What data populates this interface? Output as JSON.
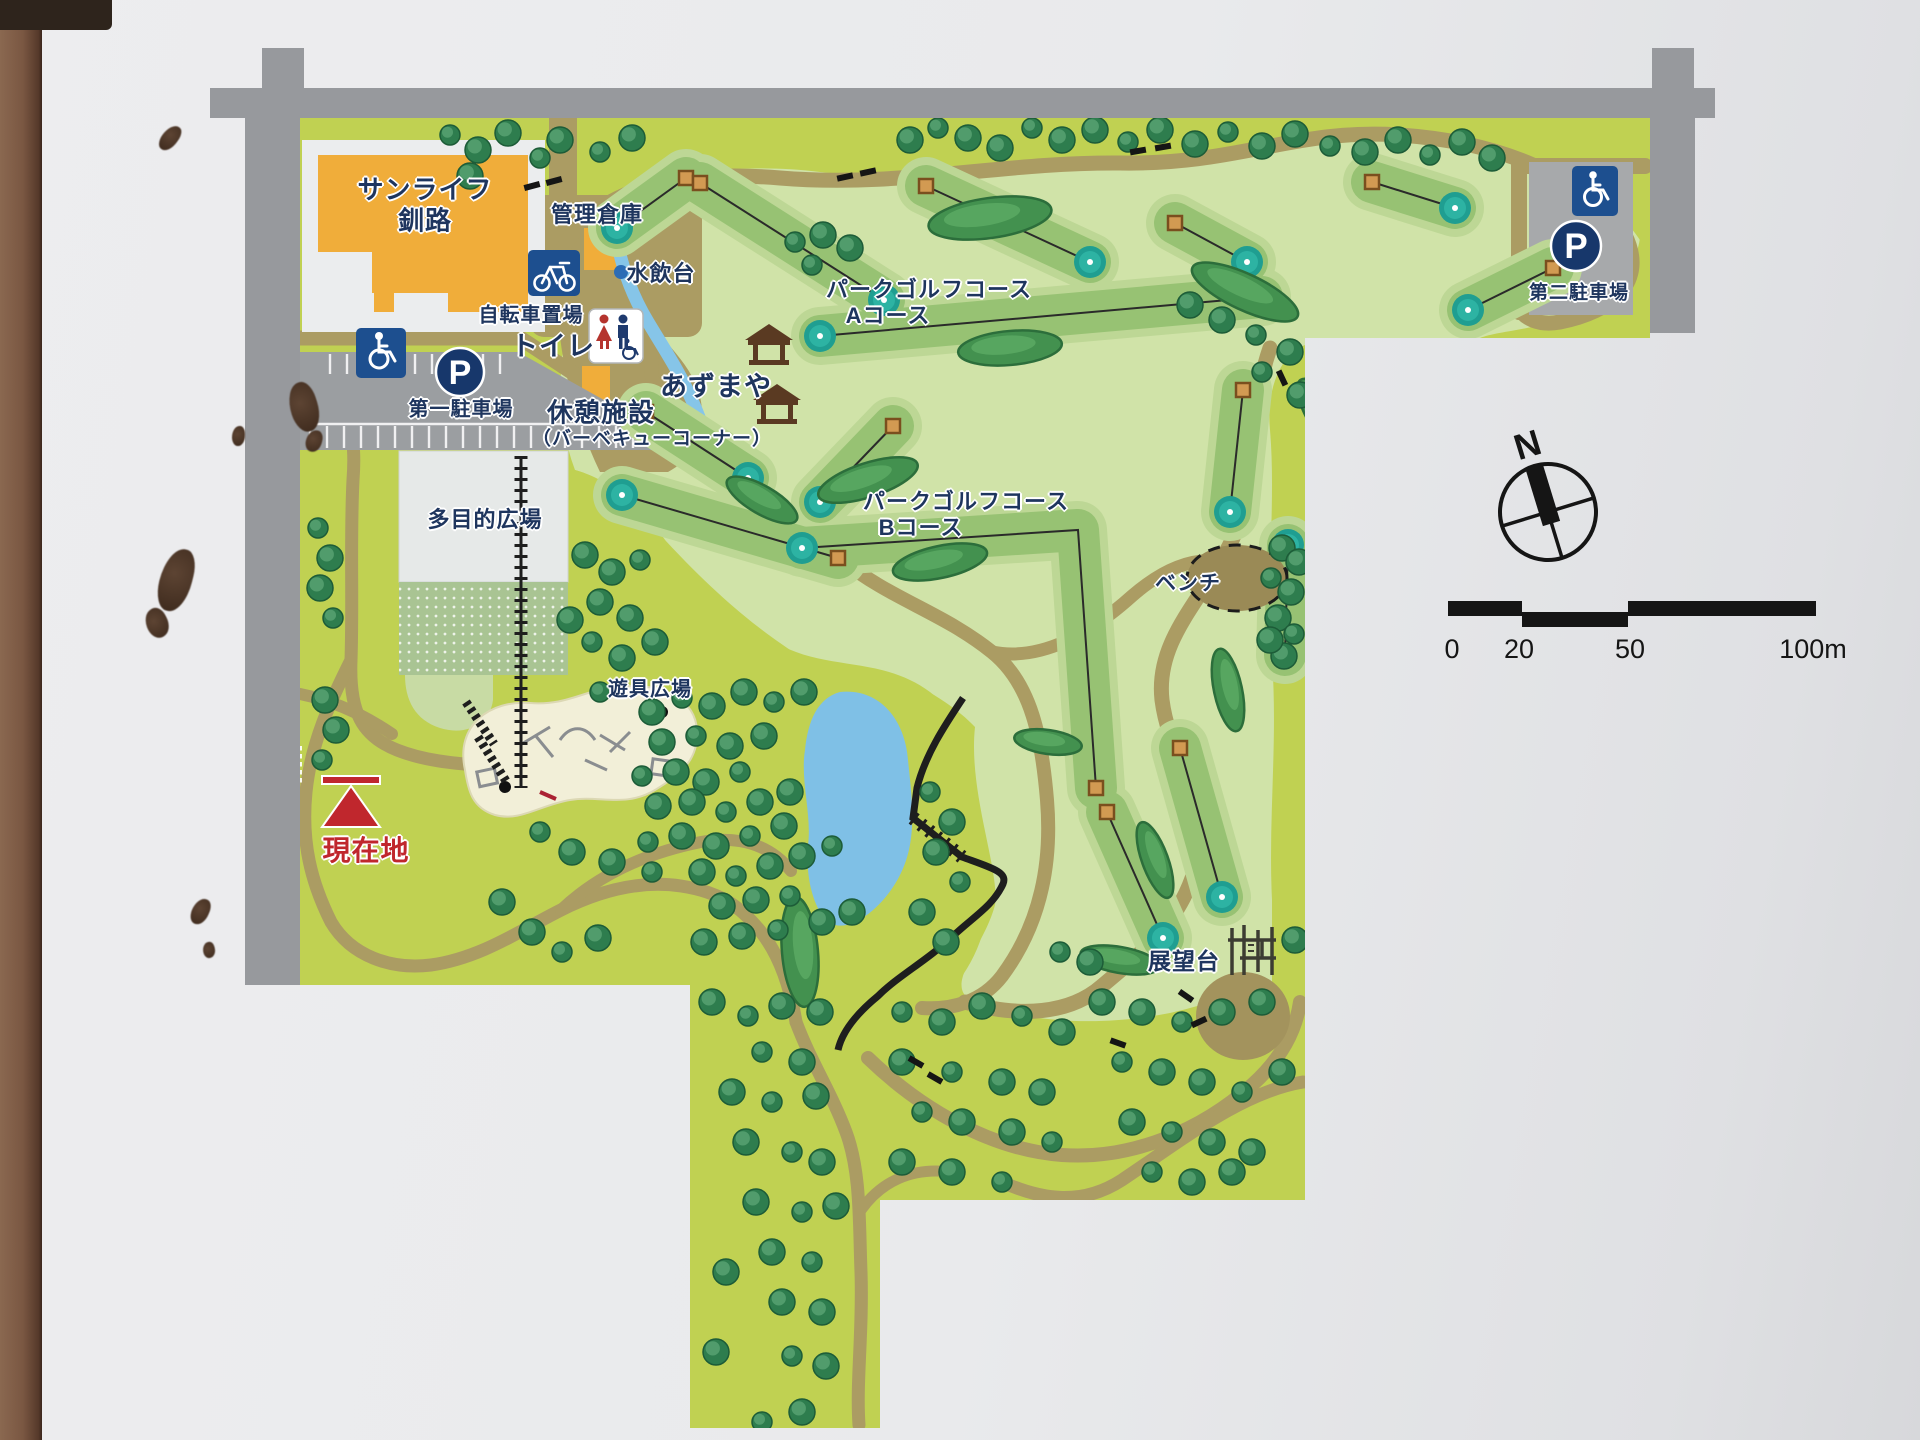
{
  "labels": {
    "sunlife1": "サンライフ",
    "sunlife2": "釧路",
    "kanri": "管理倉庫",
    "mizunomi": "水飲台",
    "jitensha": "自転車置場",
    "toilet": "トイレ",
    "azumaya": "あずまや",
    "kyukei1": "休憩施設",
    "kyukei2": "（バーベキューコーナー）",
    "parking1": "第一駐車場",
    "tamokuteki": "多目的広場",
    "yugu": "遊具広場",
    "genzaichi": "現在地",
    "courseA1": "パークゴルフコース",
    "courseA2": "Aコース",
    "courseB1": "パークゴルフコース",
    "courseB2": "Bコース",
    "bench": "ベンチ",
    "tenbodai": "展望台",
    "parking2": "第二駐車場",
    "compass_n": "N",
    "p_letter": "P"
  },
  "scalebar": {
    "ticks": [
      "0",
      "20",
      "50",
      "100m"
    ]
  },
  "colors": {
    "map_yellow": "#c0d152",
    "golf_green": "#d0e3a8",
    "fairway": "#97c273",
    "fairway_halo": "#bdd795",
    "putting_green": "#1f9e91",
    "road_gray": "#97999d",
    "parking_gray": "#9b9ea1",
    "parking2_gray": "#a7a9ab",
    "path_tan": "#ab9c63",
    "water_blue": "#86c5e8",
    "building_orange": "#f0ad3a",
    "tree_green": "#2e7d4e",
    "label_navy": "#1e355e",
    "location_red": "#c0272d",
    "icon_blue": "#1d4f8f",
    "p_navy": "#17376b",
    "playground_cream": "#f2efd8"
  },
  "map": {
    "holes": [
      {
        "tee": [
          686,
          178
        ],
        "green": [
          617,
          228
        ]
      },
      {
        "tee": [
          700,
          183
        ],
        "green": [
          884,
          300
        ]
      },
      {
        "tee": [
          926,
          186
        ],
        "green": [
          1090,
          262
        ]
      },
      {
        "tee": [
          1175,
          223
        ],
        "green": [
          1247,
          262
        ]
      },
      {
        "tee": [
          1262,
          297
        ],
        "green": [
          820,
          336
        ]
      },
      {
        "tee": [
          1553,
          268
        ],
        "green": [
          1468,
          310
        ]
      },
      {
        "tee": [
          1372,
          182
        ],
        "green": [
          1455,
          208
        ]
      },
      {
        "tee": [
          1243,
          390
        ],
        "green": [
          1230,
          512
        ]
      },
      {
        "tee": [
          646,
          412
        ],
        "green": [
          748,
          478
        ]
      },
      {
        "tee": [
          893,
          426
        ],
        "green": [
          820,
          502
        ]
      },
      {
        "tee": [
          838,
          558
        ],
        "green": [
          622,
          495
        ]
      },
      {
        "tee": [
          1096,
          788
        ],
        "elbow": [
          1078,
          530
        ],
        "green": [
          802,
          548
        ]
      },
      {
        "tee": [
          1285,
          655
        ],
        "green": [
          1288,
          545
        ]
      },
      {
        "tee": [
          1180,
          748
        ],
        "green": [
          1222,
          897
        ]
      },
      {
        "tee": [
          1107,
          812
        ],
        "green": [
          1163,
          938
        ]
      }
    ],
    "bushes": [
      [
        990,
        218,
        62,
        20,
        -8
      ],
      [
        1245,
        292,
        58,
        18,
        25
      ],
      [
        1010,
        348,
        52,
        17,
        -5
      ],
      [
        1332,
        425,
        55,
        18,
        55
      ],
      [
        868,
        480,
        52,
        17,
        -18
      ],
      [
        940,
        562,
        48,
        16,
        -12
      ],
      [
        762,
        500,
        40,
        14,
        30
      ],
      [
        1228,
        690,
        42,
        14,
        78
      ],
      [
        1048,
        742,
        34,
        12,
        8
      ],
      [
        1155,
        860,
        40,
        13,
        70
      ],
      [
        800,
        952,
        55,
        18,
        85
      ],
      [
        1120,
        960,
        40,
        13,
        10
      ]
    ],
    "trees": [
      [
        450,
        135
      ],
      [
        478,
        150
      ],
      [
        508,
        133
      ],
      [
        540,
        158
      ],
      [
        470,
        176
      ],
      [
        560,
        140
      ],
      [
        600,
        152
      ],
      [
        632,
        138
      ],
      [
        910,
        140
      ],
      [
        938,
        128
      ],
      [
        968,
        138
      ],
      [
        1000,
        148
      ],
      [
        1032,
        128
      ],
      [
        1062,
        140
      ],
      [
        1095,
        130
      ],
      [
        1128,
        142
      ],
      [
        1160,
        130
      ],
      [
        1195,
        144
      ],
      [
        1228,
        132
      ],
      [
        1262,
        146
      ],
      [
        1295,
        134
      ],
      [
        1330,
        146
      ],
      [
        1365,
        152
      ],
      [
        1398,
        140
      ],
      [
        1430,
        155
      ],
      [
        1462,
        142
      ],
      [
        1492,
        158
      ],
      [
        795,
        242
      ],
      [
        823,
        235
      ],
      [
        850,
        248
      ],
      [
        812,
        265
      ],
      [
        1190,
        305
      ],
      [
        1222,
        320
      ],
      [
        1256,
        335
      ],
      [
        1290,
        352
      ],
      [
        1300,
        395
      ],
      [
        1262,
        372
      ],
      [
        1282,
        548
      ],
      [
        1299,
        562
      ],
      [
        1271,
        578
      ],
      [
        1291,
        592
      ],
      [
        1278,
        618
      ],
      [
        1294,
        634
      ],
      [
        1284,
        656
      ],
      [
        1270,
        640
      ],
      [
        318,
        528
      ],
      [
        330,
        558
      ],
      [
        320,
        588
      ],
      [
        333,
        618
      ],
      [
        325,
        700
      ],
      [
        336,
        730
      ],
      [
        322,
        760
      ],
      [
        585,
        555
      ],
      [
        612,
        572
      ],
      [
        640,
        560
      ],
      [
        600,
        602
      ],
      [
        630,
        618
      ],
      [
        592,
        642
      ],
      [
        622,
        658
      ],
      [
        655,
        642
      ],
      [
        600,
        692
      ],
      [
        570,
        620
      ],
      [
        652,
        712
      ],
      [
        682,
        698
      ],
      [
        712,
        706
      ],
      [
        744,
        692
      ],
      [
        774,
        702
      ],
      [
        804,
        692
      ],
      [
        662,
        742
      ],
      [
        696,
        736
      ],
      [
        730,
        746
      ],
      [
        764,
        736
      ],
      [
        642,
        776
      ],
      [
        676,
        772
      ],
      [
        706,
        782
      ],
      [
        740,
        772
      ],
      [
        658,
        806
      ],
      [
        692,
        802
      ],
      [
        726,
        812
      ],
      [
        760,
        802
      ],
      [
        790,
        792
      ],
      [
        648,
        842
      ],
      [
        682,
        836
      ],
      [
        716,
        846
      ],
      [
        750,
        836
      ],
      [
        784,
        826
      ],
      [
        702,
        872
      ],
      [
        736,
        876
      ],
      [
        770,
        866
      ],
      [
        802,
        856
      ],
      [
        832,
        846
      ],
      [
        722,
        906
      ],
      [
        756,
        900
      ],
      [
        790,
        896
      ],
      [
        704,
        942
      ],
      [
        742,
        936
      ],
      [
        778,
        930
      ],
      [
        822,
        922
      ],
      [
        852,
        912
      ],
      [
        930,
        792
      ],
      [
        952,
        822
      ],
      [
        936,
        852
      ],
      [
        960,
        882
      ],
      [
        922,
        912
      ],
      [
        946,
        942
      ],
      [
        540,
        832
      ],
      [
        572,
        852
      ],
      [
        612,
        862
      ],
      [
        652,
        872
      ],
      [
        502,
        902
      ],
      [
        532,
        932
      ],
      [
        562,
        952
      ],
      [
        598,
        938
      ],
      [
        712,
        1002
      ],
      [
        748,
        1016
      ],
      [
        782,
        1006
      ],
      [
        820,
        1012
      ],
      [
        762,
        1052
      ],
      [
        802,
        1062
      ],
      [
        732,
        1092
      ],
      [
        772,
        1102
      ],
      [
        816,
        1096
      ],
      [
        746,
        1142
      ],
      [
        792,
        1152
      ],
      [
        822,
        1162
      ],
      [
        756,
        1202
      ],
      [
        802,
        1212
      ],
      [
        836,
        1206
      ],
      [
        772,
        1252
      ],
      [
        812,
        1262
      ],
      [
        782,
        1302
      ],
      [
        822,
        1312
      ],
      [
        792,
        1356
      ],
      [
        826,
        1366
      ],
      [
        802,
        1412
      ],
      [
        762,
        1422
      ],
      [
        716,
        1352
      ],
      [
        726,
        1272
      ],
      [
        902,
        1012
      ],
      [
        942,
        1022
      ],
      [
        982,
        1006
      ],
      [
        1022,
        1016
      ],
      [
        1062,
        1032
      ],
      [
        902,
        1062
      ],
      [
        952,
        1072
      ],
      [
        1002,
        1082
      ],
      [
        1042,
        1092
      ],
      [
        922,
        1112
      ],
      [
        962,
        1122
      ],
      [
        1012,
        1132
      ],
      [
        1052,
        1142
      ],
      [
        902,
        1162
      ],
      [
        952,
        1172
      ],
      [
        1002,
        1182
      ],
      [
        1102,
        1002
      ],
      [
        1142,
        1012
      ],
      [
        1182,
        1022
      ],
      [
        1222,
        1012
      ],
      [
        1262,
        1002
      ],
      [
        1122,
        1062
      ],
      [
        1162,
        1072
      ],
      [
        1202,
        1082
      ],
      [
        1242,
        1092
      ],
      [
        1282,
        1072
      ],
      [
        1132,
        1122
      ],
      [
        1172,
        1132
      ],
      [
        1212,
        1142
      ],
      [
        1252,
        1152
      ],
      [
        1152,
        1172
      ],
      [
        1192,
        1182
      ],
      [
        1232,
        1172
      ],
      [
        1060,
        952
      ],
      [
        1090,
        962
      ],
      [
        1295,
        940
      ]
    ],
    "dashes": [
      [
        532,
        186,
        -15
      ],
      [
        554,
        181,
        -15
      ],
      [
        845,
        177,
        -12
      ],
      [
        868,
        172,
        -12
      ],
      [
        1138,
        151,
        -10
      ],
      [
        1163,
        147,
        -10
      ],
      [
        1282,
        378,
        65
      ],
      [
        1186,
        996,
        35
      ],
      [
        1199,
        1022,
        -25
      ],
      [
        1118,
        1043,
        20
      ],
      [
        916,
        1062,
        30
      ],
      [
        935,
        1078,
        30
      ]
    ]
  }
}
